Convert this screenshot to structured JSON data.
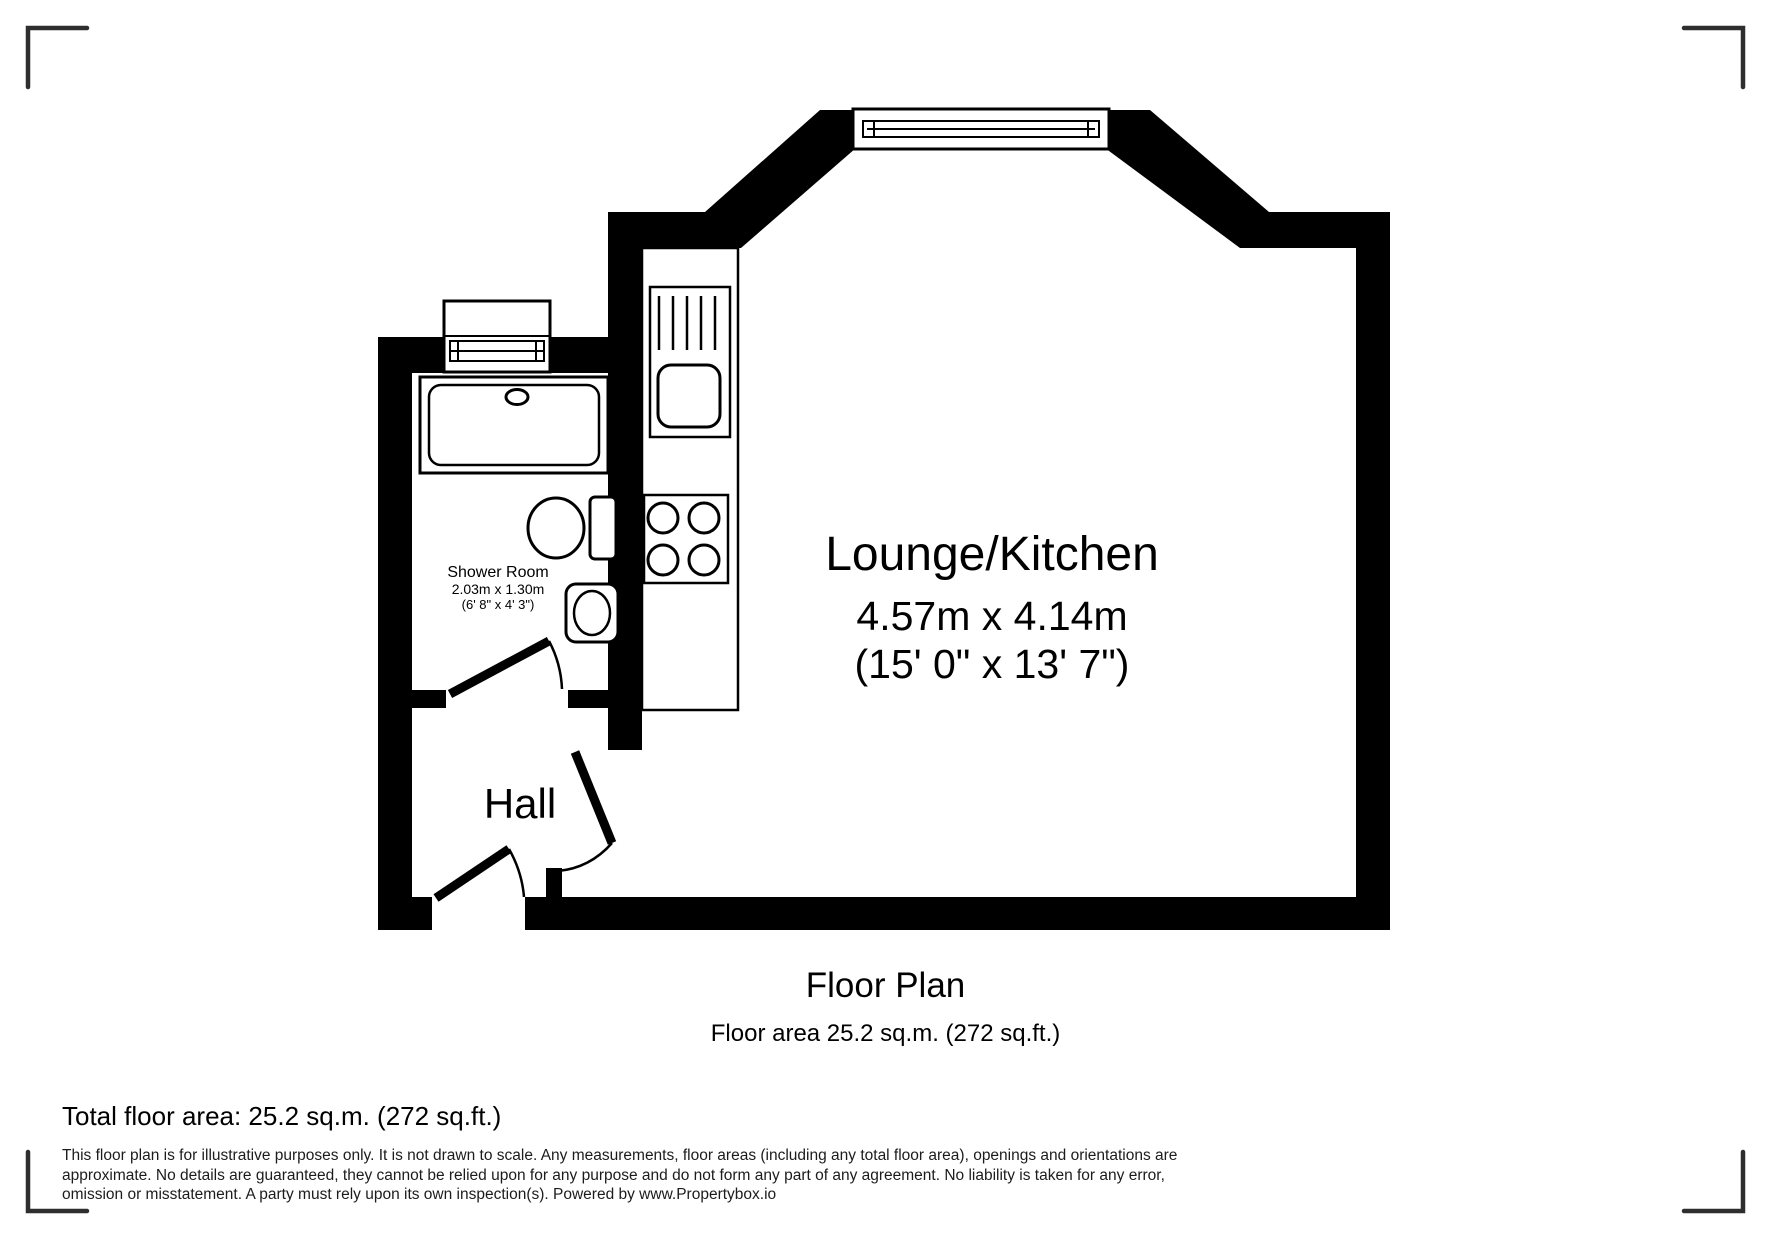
{
  "plan": {
    "rooms": [
      {
        "name": "Lounge/Kitchen",
        "metric": "4.57m x 4.14m",
        "imperial": "(15' 0\" x 13' 7\")"
      },
      {
        "name": "Shower Room",
        "metric": "2.03m x 1.30m",
        "imperial": "(6' 8\" x 4' 3\")"
      },
      {
        "name": "Hall",
        "metric": "",
        "imperial": ""
      }
    ],
    "fixtures": [
      "bay-window",
      "shower-window",
      "kitchen-counter",
      "kitchen-sink-drainer",
      "hob-4-burner",
      "shower-tray",
      "toilet",
      "wash-basin",
      "door-entrance",
      "door-shower-room",
      "door-lounge"
    ],
    "colors": {
      "wall": "#000000",
      "background": "#ffffff",
      "corner_marks": "#2e2e2e"
    }
  },
  "caption": {
    "title": "Floor Plan",
    "subtitle": "Floor area 25.2 sq.m. (272 sq.ft.)"
  },
  "footer": {
    "total": "Total floor area: 25.2 sq.m. (272 sq.ft.)",
    "disclaimer_lines": [
      "This floor plan is for illustrative purposes only. It is not drawn to scale. Any measurements, floor areas (including any total floor area), openings and orientations are",
      "approximate. No details are guaranteed, they cannot be relied upon for any purpose and do not form any part of any agreement. No liability is taken for any error,",
      "omission or misstatement. A party must rely upon its own inspection(s). Powered by www.Propertybox.io"
    ]
  }
}
